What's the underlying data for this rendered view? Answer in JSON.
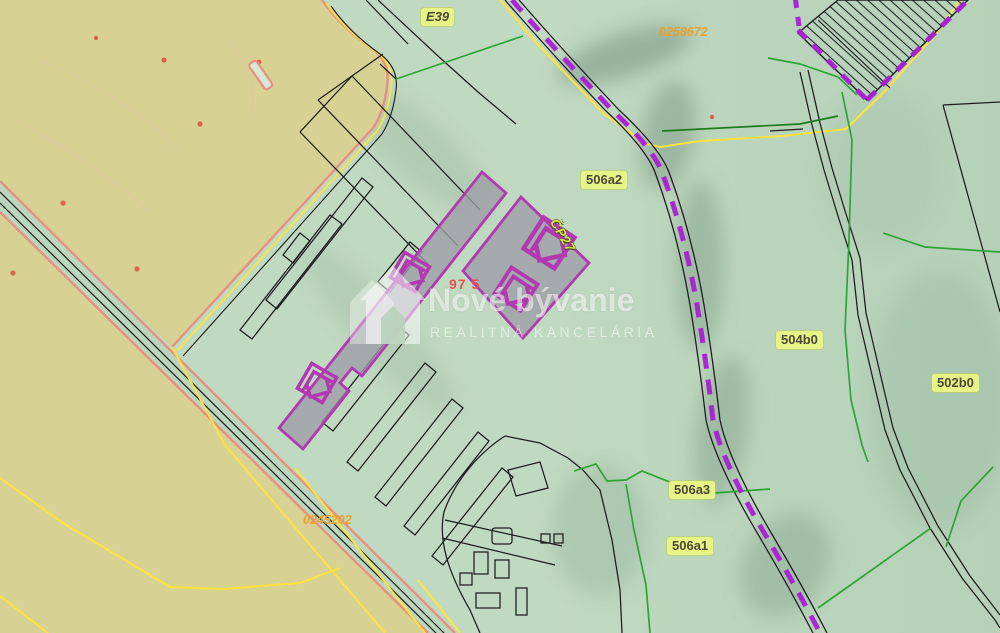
{
  "labels": {
    "road_ref": "E39",
    "code_top_right": "0258672",
    "code_bottom_left": "0245202",
    "parcel_506a2": "506a2",
    "parcel_504b0": "504b0",
    "parcel_502b0": "502b0",
    "parcel_506a3": "506a3",
    "parcel_506a1": "506a1",
    "measurement_red": "97 5",
    "rotated_parcel_code": "ČP27"
  },
  "watermark": {
    "brand": "Nové bývanie",
    "tagline": "REALITNÁ KANCELÁRIA"
  },
  "highlight": {
    "house_markers": 4,
    "selected_parcels": 2
  },
  "colors": {
    "field_tan": "#d7d293",
    "terrain_green": "#c0d9c1",
    "parcel_line_black": "#1c1c1c",
    "field_boundary_salmon": "#e89080",
    "utility_yellow": "#ffe23e",
    "land_use_green": "#2fa435",
    "forest_green_dark": "#1d7a1d",
    "cadastral_boundary_purple": "#a91fd4",
    "highlight_outline_purple": "#b13ab1",
    "highlight_fill_gray": "#9e9ca6",
    "label_pill_bg": "#e6f386",
    "label_pill_text": "#4a4a38",
    "code_orange": "#e8a12c",
    "measure_red": "#e95050"
  }
}
